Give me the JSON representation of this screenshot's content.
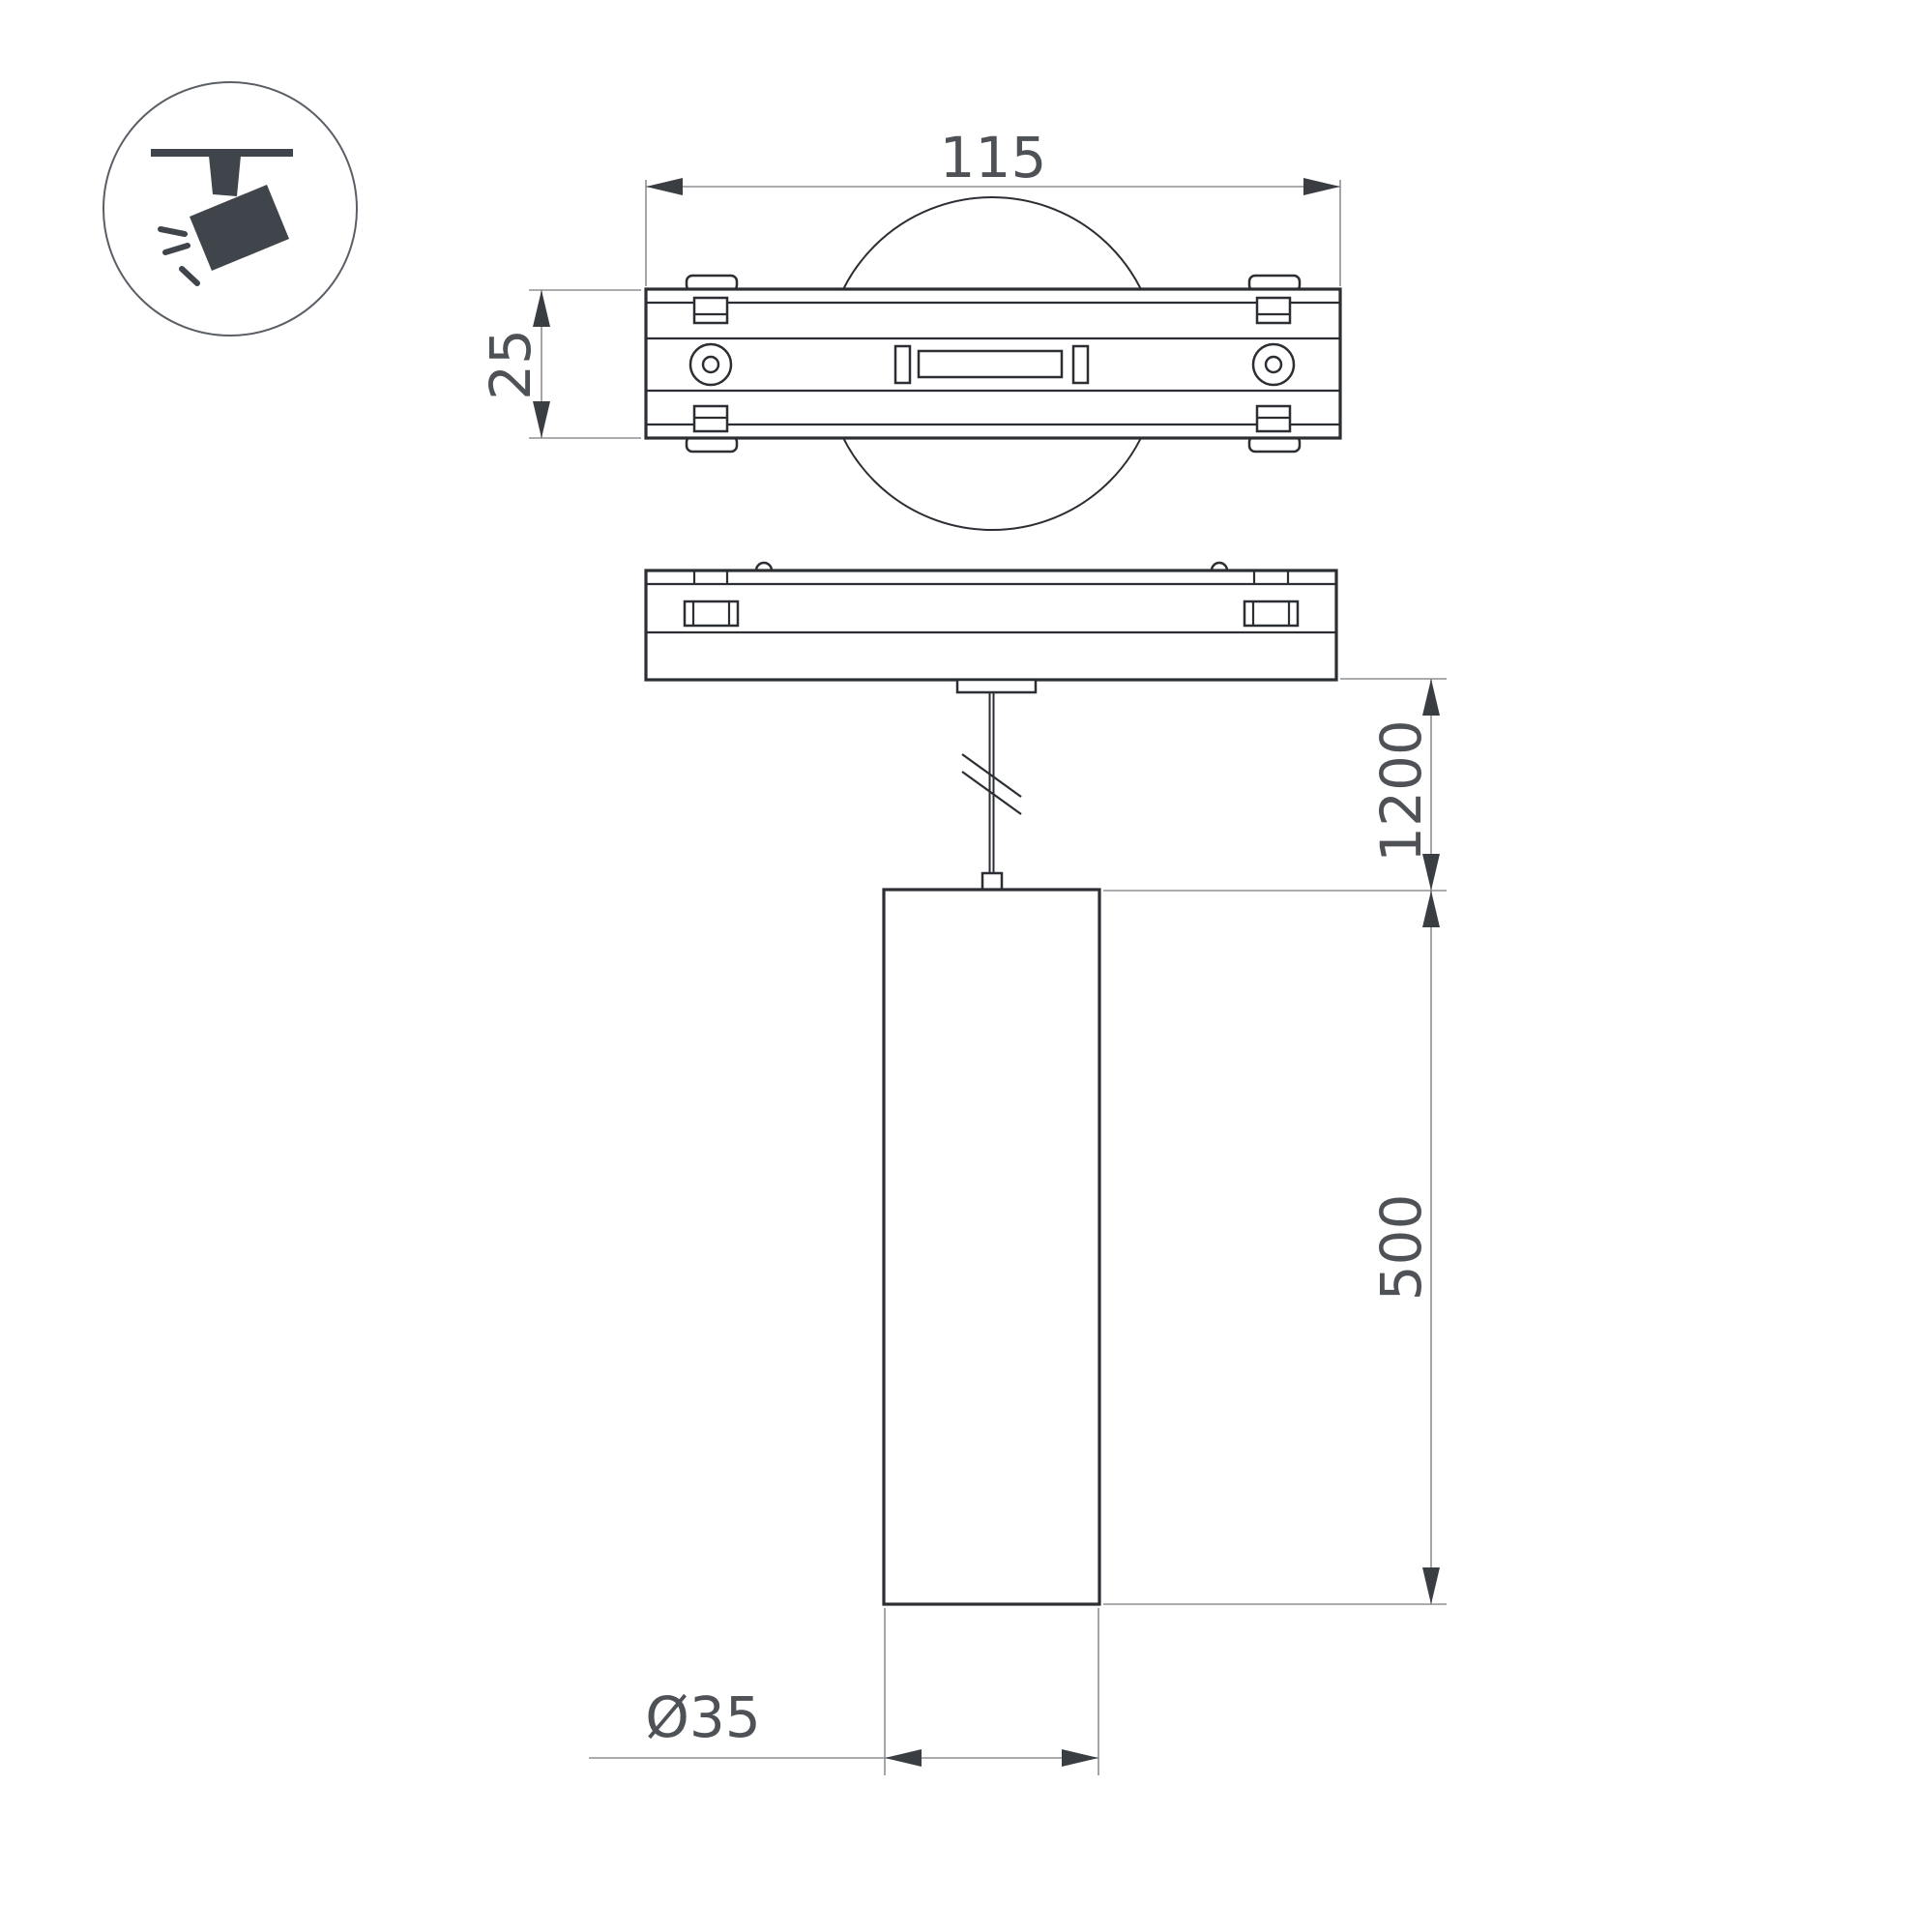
{
  "title": "Pendant track spotlight — dimensional drawing",
  "legend": {
    "icon": "track-spotlight-icon"
  },
  "labels": {
    "width": "115",
    "depth": "25",
    "adapter_height": "18.8",
    "suspension_length": "1200",
    "body_height": "500",
    "diameter": "Ø35"
  },
  "colors": {
    "background": "#ffffff",
    "object_line": "#2b2e33",
    "dimension_line": "#8d9094",
    "arrow": "#3a3e43",
    "label_text": "#4e5257",
    "icon": "#40454b"
  }
}
